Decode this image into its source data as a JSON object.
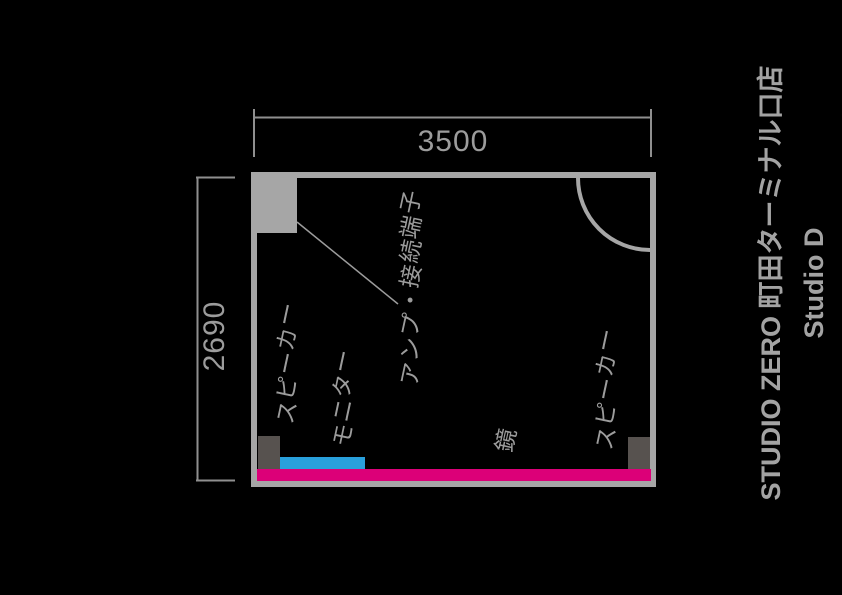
{
  "title": {
    "studio_name": "STUDIO ZERO 町田ターミナル口店",
    "room_name": "Studio D"
  },
  "dimensions": {
    "width_mm": "3500",
    "height_mm": "2690"
  },
  "room": {
    "labels": {
      "speaker_left": "スピーカー",
      "monitor": "モニター",
      "amp_terminal": "アンプ・接続端子",
      "mirror": "鏡",
      "speaker_right": "スピーカー"
    }
  },
  "colors": {
    "background": "#000000",
    "wall_gray": "#a6a6a6",
    "dimension_line_gray": "#8f8f8f",
    "label_gray": "#9c9c9c",
    "title_gray": "#a3a3a3",
    "monitor_blue": "#29a0dc",
    "mirror_magenta": "#dc0078",
    "speaker_dark_gray": "#57524f"
  }
}
